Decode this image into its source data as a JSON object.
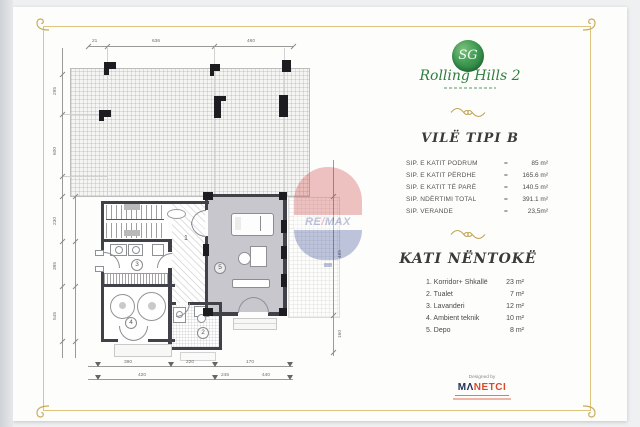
{
  "branding": {
    "monogram": "SG",
    "name": "Rolling Hills 2"
  },
  "title_block": {
    "title": "VILË TIPI B",
    "rows": [
      {
        "label": "SIP. E KATIT PODRUM",
        "eq": "=",
        "value": "85 m²"
      },
      {
        "label": "SIP. E KATIT PËRDHE",
        "eq": "=",
        "value": "165.6 m²"
      },
      {
        "label": "SIP. E KATIT TË PARË",
        "eq": "=",
        "value": "140.5 m²"
      },
      {
        "label": "SIP. NDËRTIMI TOTAL",
        "eq": "=",
        "value": "391.1 m²"
      },
      {
        "label": "SIP. VERANDE",
        "eq": "=",
        "value": "23,5m²"
      }
    ]
  },
  "floor_block": {
    "title": "KATI NËNTOKË",
    "rooms": [
      {
        "name": "1. Korridor+ Shkallë",
        "area": "23 m²"
      },
      {
        "name": "2. Tualet",
        "area": "7 m²"
      },
      {
        "name": "3. Lavanderi",
        "area": "12 m²"
      },
      {
        "name": "4. Ambient teknik",
        "area": "10 m²"
      },
      {
        "name": "5. Depo",
        "area": "8 m²"
      }
    ]
  },
  "designer": {
    "prefix": "Designed by",
    "m": "M",
    "a": "Λ",
    "rest": "NETCI"
  },
  "watermark": {
    "re": "RE",
    "slash": "/",
    "max": "MAX"
  },
  "plan": {
    "room_labels": {
      "r1": "1",
      "r2": "2",
      "r3": "3",
      "r4": "4",
      "r5": "5"
    },
    "dims": {
      "top": [
        "21",
        "636",
        "460"
      ],
      "left": [
        "295",
        "600",
        "230",
        "395",
        "545"
      ],
      "right": [
        "485",
        "160"
      ],
      "bottom_row1": [
        "390",
        "220",
        "170"
      ],
      "bottom_row2": [
        "420",
        "245",
        "440"
      ]
    }
  },
  "colors": {
    "accent_gold": "#c9ab5a",
    "logo_green": "#2e8b45",
    "remax_red": "#cf3b3b",
    "remax_blue": "#2b3f8e",
    "designer_navy": "#223055",
    "designer_orange": "#d94a2a"
  }
}
